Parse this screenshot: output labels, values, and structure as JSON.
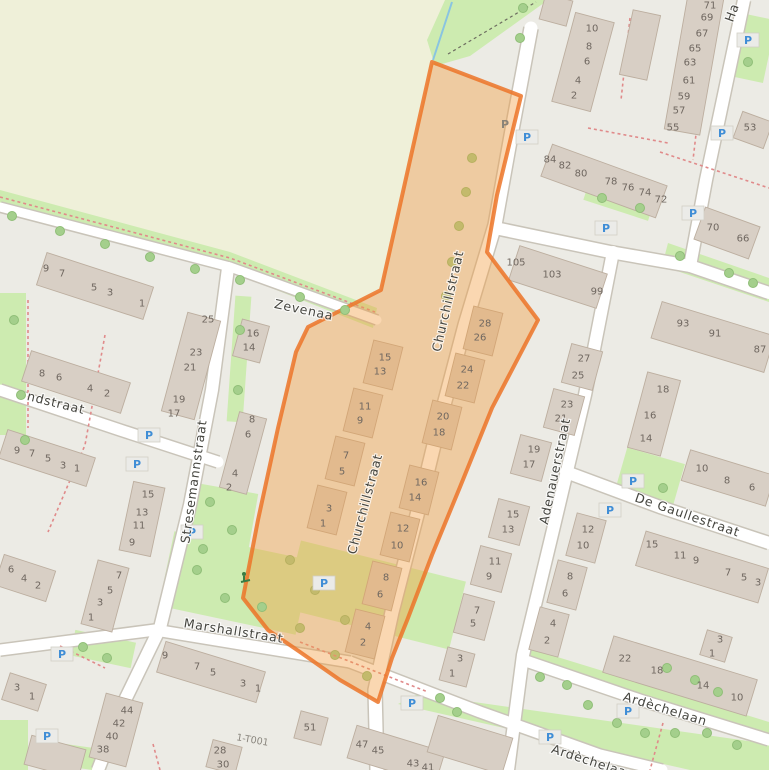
{
  "map": {
    "colors": {
      "highlight_stroke": "#ec7428",
      "highlight_fill": "#f29a3d",
      "grass": "#cdebb0",
      "farmland": "#eff0d9",
      "road": "#ffffff",
      "building": "#d8cfc5",
      "parking_blue": "#3f8dd6",
      "housenumber_text": "#6f6760",
      "street_text": "#45453f",
      "stream_blue": "#89c4e1"
    },
    "street_labels": [
      {
        "name": "Churchillstraat",
        "x": 452,
        "y": 302,
        "rot": -77
      },
      {
        "name": "Churchillstraat",
        "x": 369,
        "y": 505,
        "rot": -75
      },
      {
        "name": "Stresemannstraat",
        "x": 198,
        "y": 482,
        "rot": -82
      },
      {
        "name": "Adenauerstraat",
        "x": 559,
        "y": 472,
        "rot": -78
      },
      {
        "name": "De Gaullestraat",
        "x": 686,
        "y": 519,
        "rot": 19
      },
      {
        "name": "Zevenaa",
        "x": 303,
        "y": 314,
        "rot": 12
      },
      {
        "name": "ndstraat",
        "x": 55,
        "y": 407,
        "rot": 14
      },
      {
        "name": "Marshallstraat",
        "x": 233,
        "y": 635,
        "rot": 9
      },
      {
        "name": "Ardèchelaan",
        "x": 664,
        "y": 713,
        "rot": 17
      },
      {
        "name": "Ardèchelaan",
        "x": 592,
        "y": 766,
        "rot": 18
      },
      {
        "name": "Ha",
        "x": 736,
        "y": 14,
        "rot": -70
      }
    ],
    "special_labels": [
      {
        "text": "1-T001",
        "x": 252,
        "y": 743,
        "rot": 10
      }
    ],
    "house_numbers": [
      {
        "n": "10",
        "x": 592,
        "y": 28
      },
      {
        "n": "8",
        "x": 589,
        "y": 46
      },
      {
        "n": "6",
        "x": 587,
        "y": 61
      },
      {
        "n": "4",
        "x": 578,
        "y": 80
      },
      {
        "n": "2",
        "x": 574,
        "y": 95
      },
      {
        "n": "71",
        "x": 710,
        "y": 5
      },
      {
        "n": "69",
        "x": 707,
        "y": 17
      },
      {
        "n": "67",
        "x": 702,
        "y": 33
      },
      {
        "n": "65",
        "x": 695,
        "y": 48
      },
      {
        "n": "63",
        "x": 690,
        "y": 62
      },
      {
        "n": "61",
        "x": 689,
        "y": 80
      },
      {
        "n": "59",
        "x": 684,
        "y": 96
      },
      {
        "n": "57",
        "x": 679,
        "y": 110
      },
      {
        "n": "55",
        "x": 673,
        "y": 127
      },
      {
        "n": "53",
        "x": 750,
        "y": 127
      },
      {
        "n": "84",
        "x": 550,
        "y": 159
      },
      {
        "n": "82",
        "x": 565,
        "y": 165
      },
      {
        "n": "80",
        "x": 581,
        "y": 173
      },
      {
        "n": "78",
        "x": 611,
        "y": 181
      },
      {
        "n": "76",
        "x": 628,
        "y": 187
      },
      {
        "n": "74",
        "x": 645,
        "y": 192
      },
      {
        "n": "72",
        "x": 661,
        "y": 199
      },
      {
        "n": "70",
        "x": 713,
        "y": 227
      },
      {
        "n": "66",
        "x": 743,
        "y": 238
      },
      {
        "n": "105",
        "x": 516,
        "y": 262
      },
      {
        "n": "103",
        "x": 552,
        "y": 274
      },
      {
        "n": "99",
        "x": 597,
        "y": 291
      },
      {
        "n": "27",
        "x": 584,
        "y": 358
      },
      {
        "n": "25",
        "x": 578,
        "y": 375
      },
      {
        "n": "23",
        "x": 567,
        "y": 404
      },
      {
        "n": "21",
        "x": 561,
        "y": 418
      },
      {
        "n": "19",
        "x": 534,
        "y": 449
      },
      {
        "n": "17",
        "x": 529,
        "y": 464
      },
      {
        "n": "15",
        "x": 513,
        "y": 514
      },
      {
        "n": "13",
        "x": 508,
        "y": 529
      },
      {
        "n": "11",
        "x": 495,
        "y": 561
      },
      {
        "n": "9",
        "x": 489,
        "y": 576
      },
      {
        "n": "7",
        "x": 477,
        "y": 610
      },
      {
        "n": "5",
        "x": 473,
        "y": 623
      },
      {
        "n": "12",
        "x": 588,
        "y": 529
      },
      {
        "n": "10",
        "x": 583,
        "y": 545
      },
      {
        "n": "8",
        "x": 570,
        "y": 576
      },
      {
        "n": "6",
        "x": 565,
        "y": 593
      },
      {
        "n": "4",
        "x": 553,
        "y": 623
      },
      {
        "n": "2",
        "x": 547,
        "y": 640
      },
      {
        "n": "93",
        "x": 683,
        "y": 323
      },
      {
        "n": "91",
        "x": 715,
        "y": 333
      },
      {
        "n": "87",
        "x": 760,
        "y": 349
      },
      {
        "n": "18",
        "x": 663,
        "y": 389
      },
      {
        "n": "16",
        "x": 650,
        "y": 415
      },
      {
        "n": "14",
        "x": 646,
        "y": 438
      },
      {
        "n": "10",
        "x": 702,
        "y": 468
      },
      {
        "n": "8",
        "x": 727,
        "y": 480
      },
      {
        "n": "6",
        "x": 752,
        "y": 487
      },
      {
        "n": "15",
        "x": 652,
        "y": 544
      },
      {
        "n": "11",
        "x": 680,
        "y": 555
      },
      {
        "n": "9",
        "x": 696,
        "y": 560
      },
      {
        "n": "7",
        "x": 728,
        "y": 572
      },
      {
        "n": "5",
        "x": 744,
        "y": 577
      },
      {
        "n": "3",
        "x": 758,
        "y": 582
      },
      {
        "n": "22",
        "x": 625,
        "y": 658
      },
      {
        "n": "18",
        "x": 657,
        "y": 670
      },
      {
        "n": "14",
        "x": 703,
        "y": 685
      },
      {
        "n": "10",
        "x": 737,
        "y": 697
      },
      {
        "n": "3",
        "x": 720,
        "y": 639
      },
      {
        "n": "1",
        "x": 712,
        "y": 653
      },
      {
        "n": "15",
        "x": 385,
        "y": 357
      },
      {
        "n": "13",
        "x": 380,
        "y": 371
      },
      {
        "n": "11",
        "x": 365,
        "y": 406
      },
      {
        "n": "9",
        "x": 360,
        "y": 420
      },
      {
        "n": "7",
        "x": 346,
        "y": 455
      },
      {
        "n": "5",
        "x": 342,
        "y": 471
      },
      {
        "n": "3",
        "x": 329,
        "y": 508
      },
      {
        "n": "1",
        "x": 323,
        "y": 523
      },
      {
        "n": "28",
        "x": 485,
        "y": 323
      },
      {
        "n": "26",
        "x": 480,
        "y": 337
      },
      {
        "n": "24",
        "x": 467,
        "y": 369
      },
      {
        "n": "22",
        "x": 463,
        "y": 385
      },
      {
        "n": "20",
        "x": 443,
        "y": 416
      },
      {
        "n": "18",
        "x": 439,
        "y": 432
      },
      {
        "n": "16",
        "x": 421,
        "y": 482
      },
      {
        "n": "14",
        "x": 415,
        "y": 497
      },
      {
        "n": "12",
        "x": 403,
        "y": 528
      },
      {
        "n": "10",
        "x": 397,
        "y": 545
      },
      {
        "n": "8",
        "x": 386,
        "y": 577
      },
      {
        "n": "6",
        "x": 380,
        "y": 594
      },
      {
        "n": "4",
        "x": 368,
        "y": 626
      },
      {
        "n": "2",
        "x": 363,
        "y": 642
      },
      {
        "n": "9",
        "x": 46,
        "y": 268
      },
      {
        "n": "7",
        "x": 62,
        "y": 273
      },
      {
        "n": "5",
        "x": 94,
        "y": 287
      },
      {
        "n": "3",
        "x": 110,
        "y": 292
      },
      {
        "n": "1",
        "x": 142,
        "y": 303
      },
      {
        "n": "25",
        "x": 208,
        "y": 319
      },
      {
        "n": "23",
        "x": 196,
        "y": 352
      },
      {
        "n": "21",
        "x": 190,
        "y": 367
      },
      {
        "n": "19",
        "x": 179,
        "y": 399
      },
      {
        "n": "17",
        "x": 174,
        "y": 413
      },
      {
        "n": "8",
        "x": 42,
        "y": 373
      },
      {
        "n": "6",
        "x": 59,
        "y": 377
      },
      {
        "n": "4",
        "x": 90,
        "y": 388
      },
      {
        "n": "2",
        "x": 107,
        "y": 393
      },
      {
        "n": "16",
        "x": 253,
        "y": 333
      },
      {
        "n": "14",
        "x": 249,
        "y": 347
      },
      {
        "n": "9",
        "x": 17,
        "y": 450
      },
      {
        "n": "7",
        "x": 32,
        "y": 453
      },
      {
        "n": "5",
        "x": 48,
        "y": 458
      },
      {
        "n": "3",
        "x": 63,
        "y": 465
      },
      {
        "n": "1",
        "x": 77,
        "y": 468
      },
      {
        "n": "15",
        "x": 148,
        "y": 494
      },
      {
        "n": "13",
        "x": 142,
        "y": 512
      },
      {
        "n": "11",
        "x": 139,
        "y": 525
      },
      {
        "n": "9",
        "x": 132,
        "y": 542
      },
      {
        "n": "8",
        "x": 252,
        "y": 419
      },
      {
        "n": "6",
        "x": 248,
        "y": 434
      },
      {
        "n": "4",
        "x": 235,
        "y": 473
      },
      {
        "n": "2",
        "x": 229,
        "y": 487
      },
      {
        "n": "6",
        "x": 11,
        "y": 569
      },
      {
        "n": "4",
        "x": 24,
        "y": 578
      },
      {
        "n": "2",
        "x": 38,
        "y": 585
      },
      {
        "n": "7",
        "x": 119,
        "y": 575
      },
      {
        "n": "5",
        "x": 110,
        "y": 590
      },
      {
        "n": "3",
        "x": 100,
        "y": 602
      },
      {
        "n": "1",
        "x": 91,
        "y": 617
      },
      {
        "n": "9",
        "x": 165,
        "y": 655
      },
      {
        "n": "7",
        "x": 197,
        "y": 666
      },
      {
        "n": "5",
        "x": 213,
        "y": 672
      },
      {
        "n": "3",
        "x": 243,
        "y": 683
      },
      {
        "n": "1",
        "x": 258,
        "y": 688
      },
      {
        "n": "44",
        "x": 127,
        "y": 710
      },
      {
        "n": "42",
        "x": 119,
        "y": 723
      },
      {
        "n": "40",
        "x": 112,
        "y": 736
      },
      {
        "n": "38",
        "x": 103,
        "y": 749
      },
      {
        "n": "28",
        "x": 220,
        "y": 750
      },
      {
        "n": "30",
        "x": 223,
        "y": 764
      },
      {
        "n": "3",
        "x": 17,
        "y": 687
      },
      {
        "n": "1",
        "x": 32,
        "y": 696
      },
      {
        "n": "51",
        "x": 310,
        "y": 727
      },
      {
        "n": "47",
        "x": 362,
        "y": 744
      },
      {
        "n": "45",
        "x": 378,
        "y": 750
      },
      {
        "n": "43",
        "x": 413,
        "y": 763
      },
      {
        "n": "41",
        "x": 428,
        "y": 767
      },
      {
        "n": "3",
        "x": 460,
        "y": 658
      },
      {
        "n": "1",
        "x": 452,
        "y": 673
      }
    ],
    "parking_icons": [
      {
        "x": 748,
        "y": 40
      },
      {
        "x": 722,
        "y": 133
      },
      {
        "x": 693,
        "y": 213
      },
      {
        "x": 606,
        "y": 228
      },
      {
        "x": 527,
        "y": 137
      },
      {
        "x": 149,
        "y": 435
      },
      {
        "x": 137,
        "y": 464
      },
      {
        "x": 192,
        "y": 532
      },
      {
        "x": 633,
        "y": 481
      },
      {
        "x": 610,
        "y": 510
      },
      {
        "x": 324,
        "y": 583
      },
      {
        "x": 412,
        "y": 703
      },
      {
        "x": 550,
        "y": 737
      },
      {
        "x": 628,
        "y": 711
      },
      {
        "x": 62,
        "y": 654
      },
      {
        "x": 47,
        "y": 736
      },
      {
        "x": 505,
        "y": 124,
        "gray": true
      }
    ],
    "trees_under_highlight": [
      {
        "x": 472,
        "y": 158
      },
      {
        "x": 466,
        "y": 192
      },
      {
        "x": 459,
        "y": 226
      },
      {
        "x": 452,
        "y": 262
      },
      {
        "x": 446,
        "y": 296
      },
      {
        "x": 290,
        "y": 560
      },
      {
        "x": 315,
        "y": 590
      },
      {
        "x": 345,
        "y": 620
      },
      {
        "x": 300,
        "y": 628
      },
      {
        "x": 335,
        "y": 655
      },
      {
        "x": 367,
        "y": 676
      }
    ],
    "trees": [
      {
        "x": 12,
        "y": 216
      },
      {
        "x": 60,
        "y": 231
      },
      {
        "x": 105,
        "y": 244
      },
      {
        "x": 150,
        "y": 257
      },
      {
        "x": 195,
        "y": 269
      },
      {
        "x": 240,
        "y": 280
      },
      {
        "x": 300,
        "y": 297
      },
      {
        "x": 345,
        "y": 310
      },
      {
        "x": 523,
        "y": 8
      },
      {
        "x": 520,
        "y": 38
      },
      {
        "x": 14,
        "y": 320
      },
      {
        "x": 21,
        "y": 395
      },
      {
        "x": 25,
        "y": 440
      },
      {
        "x": 210,
        "y": 502
      },
      {
        "x": 232,
        "y": 530
      },
      {
        "x": 203,
        "y": 549
      },
      {
        "x": 197,
        "y": 570
      },
      {
        "x": 225,
        "y": 598
      },
      {
        "x": 262,
        "y": 607
      },
      {
        "x": 748,
        "y": 62
      },
      {
        "x": 602,
        "y": 198
      },
      {
        "x": 640,
        "y": 208
      },
      {
        "x": 680,
        "y": 256
      },
      {
        "x": 729,
        "y": 273
      },
      {
        "x": 753,
        "y": 283
      },
      {
        "x": 663,
        "y": 488
      },
      {
        "x": 540,
        "y": 677
      },
      {
        "x": 567,
        "y": 685
      },
      {
        "x": 588,
        "y": 705
      },
      {
        "x": 617,
        "y": 723
      },
      {
        "x": 645,
        "y": 733
      },
      {
        "x": 675,
        "y": 733
      },
      {
        "x": 707,
        "y": 733
      },
      {
        "x": 737,
        "y": 745
      },
      {
        "x": 457,
        "y": 712
      },
      {
        "x": 440,
        "y": 698
      },
      {
        "x": 667,
        "y": 668
      },
      {
        "x": 695,
        "y": 680
      },
      {
        "x": 718,
        "y": 692
      },
      {
        "x": 83,
        "y": 647
      },
      {
        "x": 107,
        "y": 658
      },
      {
        "x": 240,
        "y": 330
      },
      {
        "x": 238,
        "y": 390
      }
    ]
  }
}
